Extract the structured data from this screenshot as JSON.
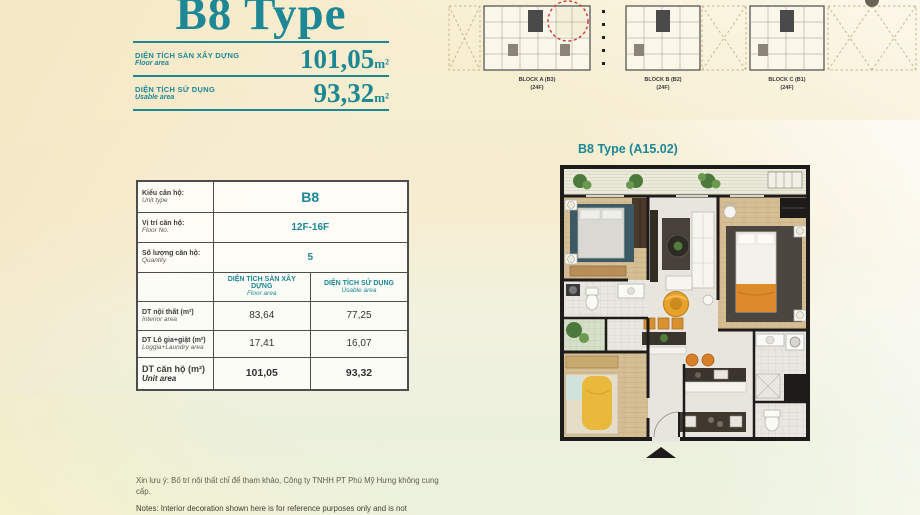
{
  "colors": {
    "teal": "#1d8795",
    "highlight_red": "#cc3b33",
    "wall": "#1e1c1a"
  },
  "header": {
    "title": "B8 Type",
    "rows": [
      {
        "label_vi": "DIỆN TÍCH SÀN XÂY DỰNG",
        "label_en": "Floor area",
        "value": "101,05",
        "unit": "m²"
      },
      {
        "label_vi": "DIỆN TÍCH SỬ DỤNG",
        "label_en": "Usable area",
        "value": "93,32",
        "unit": "m²"
      }
    ]
  },
  "site_plan": {
    "blocks": [
      {
        "name": "BLOCK A (B3)",
        "floors": "(24F)"
      },
      {
        "name": "BLOCK B (B2)",
        "floors": "(24F)"
      },
      {
        "name": "BLOCK C (B1)",
        "floors": "(24F)"
      }
    ]
  },
  "spec_table": {
    "rows": [
      {
        "label_vi": "Kiểu căn hộ:",
        "label_en": "Unit type",
        "value": "B8"
      },
      {
        "label_vi": "Vị trí căn hộ:",
        "label_en": "Floor No.",
        "value": "12F-16F"
      },
      {
        "label_vi": "Số lượng căn hộ:",
        "label_en": "Quantity",
        "value": "5"
      }
    ],
    "area_header": {
      "col1_vi": "DIỆN TÍCH SÀN XÂY DỰNG",
      "col1_en": "Floor area",
      "col2_vi": "DIỆN TÍCH SỬ DỤNG",
      "col2_en": "Usable area"
    },
    "area_rows": [
      {
        "label_vi": "DT nội thất  (m²)",
        "label_en": "Interior area",
        "floor": "83,64",
        "usable": "77,25"
      },
      {
        "label_vi": "DT Lô gia+giặt  (m²)",
        "label_en": "Loggia+Laundry area",
        "floor": "17,41",
        "usable": "16,07"
      },
      {
        "label_vi": "DT căn hộ (m²)",
        "label_en": "Unit area",
        "floor": "101,05",
        "usable": "93,32"
      }
    ]
  },
  "floor_plan": {
    "title": "B8 Type (A15.02)"
  },
  "notes": {
    "vi": "Xin lưu ý: Bố trí nội thất chỉ để tham khảo, Công ty TNHH PT Phú Mỹ Hưng không cung cấp.",
    "en": "Notes: Interior decoration shown here is for reference purposes only and is not"
  }
}
